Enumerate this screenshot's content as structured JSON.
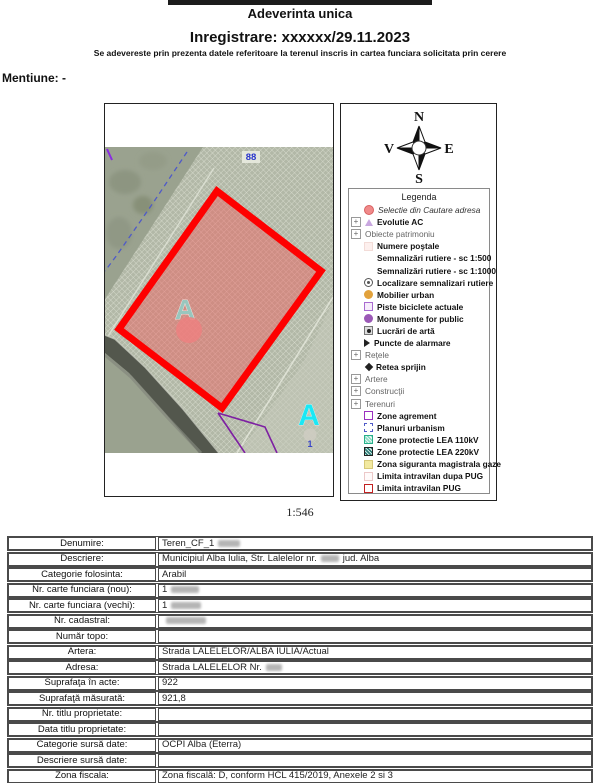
{
  "header": {
    "title": "Adeverinta unica",
    "registration": "Inregistrare: xxxxxx/29.11.2023",
    "subtitle": "Se adevereste prin prezenta datele referitoare la terenul inscris in cartea funciara solicitata prin cerere",
    "mention": "Mentiune: -"
  },
  "map": {
    "scale": "1:546",
    "labels": {
      "parcel": "88",
      "zone_letter": "A",
      "zone_letter_right": "A",
      "point": "1"
    },
    "colors": {
      "selection_stroke": "#fe0000",
      "selection_fill": "rgba(240,90,90,0.45)",
      "marker": "#ef8080",
      "letter_teal": "#8fd0c8",
      "letter_cyan": "#1ae8f5"
    }
  },
  "compass": {
    "north": "N",
    "south": "S",
    "east": "E",
    "west": "V"
  },
  "legend": {
    "title": "Legenda",
    "items": [
      {
        "label": "Selectie din Cautare adresa",
        "icon": "red-circle",
        "italic": true
      },
      {
        "label": "Evolutie AC",
        "icon": "purple-triangle",
        "expand": true,
        "bold": true
      },
      {
        "label": "Obiecte patrimoniu",
        "expand": true,
        "group": true
      },
      {
        "label": "Numere poştale",
        "icon": "pink-square",
        "bold": true
      },
      {
        "label": "Semnalizări rutiere - sc 1:500",
        "bold": true
      },
      {
        "label": "Semnalizări rutiere - sc 1:1000",
        "bold": true
      },
      {
        "label": "Localizare semnalizari rutiere",
        "icon": "circle-dot",
        "bold": true
      },
      {
        "label": "Mobilier urban",
        "icon": "orange-dot",
        "bold": true
      },
      {
        "label": "Piste biciclete actuale",
        "icon": "purple-border-square",
        "bold": true
      },
      {
        "label": "Monumente for public",
        "icon": "purple-dot",
        "bold": true
      },
      {
        "label": "Lucrări de artă",
        "icon": "art-icon",
        "bold": true
      },
      {
        "label": "Puncte de alarmare",
        "icon": "black-triangle-right",
        "bold": true
      },
      {
        "label": "Reţele",
        "expand": true,
        "group": true
      },
      {
        "label": "Retea sprijin",
        "icon": "black-diamond",
        "bold": true
      },
      {
        "label": "Artere",
        "expand": true,
        "group": true
      },
      {
        "label": "Construcţii",
        "expand": true,
        "group": true
      },
      {
        "label": "Terenuri",
        "expand": true,
        "group": true
      },
      {
        "label": "Zone agrement",
        "icon": "purple-square",
        "bold": true
      },
      {
        "label": "Planuri urbanism",
        "icon": "dashed-blue-square",
        "bold": true
      },
      {
        "label": "Zone protectie LEA 110kV",
        "icon": "teal-hatch",
        "bold": true
      },
      {
        "label": "Zone protectie LEA 220kV",
        "icon": "dark-hatch",
        "bold": true
      },
      {
        "label": "Zona siguranta magistrala gaze",
        "icon": "yellow-square",
        "bold": true
      },
      {
        "label": "Limita intravilan dupa PUG",
        "icon": "pink-border-square",
        "bold": true
      },
      {
        "label": "Limita intravilan PUG",
        "icon": "red-border-square",
        "bold": true
      }
    ]
  },
  "table": {
    "rows": [
      {
        "label": "Denumire:",
        "value": "Teren_CF_1",
        "redact": 22
      },
      {
        "label": "Descriere:",
        "value": "Municipiul Alba Iulia, Str. Lalelelor nr.",
        "redact": 18,
        "value2": "jud. Alba"
      },
      {
        "label": "Categorie folosinta:",
        "value": "Arabil"
      },
      {
        "label": "Nr. carte funciara (nou):",
        "value": "1",
        "redact": 28
      },
      {
        "label": "Nr. carte funciara (vechi):",
        "value": "1",
        "redact": 30
      },
      {
        "label": "Nr. cadastral:",
        "value": "",
        "redact": 40
      },
      {
        "label": "Număr topo:",
        "value": ""
      },
      {
        "label": "Artera:",
        "value": "Strada LALELELOR/ALBA IULIA/Actual"
      },
      {
        "label": "Adresa:",
        "value": "Strada LALELELOR Nr.",
        "redact": 16
      },
      {
        "label": "Suprafaţa în acte:",
        "value": "922"
      },
      {
        "label": "Suprafaţă măsurată:",
        "value": "921,8"
      },
      {
        "label": "Nr. titlu proprietate:",
        "value": ""
      },
      {
        "label": "Data titlu proprietate:",
        "value": ""
      },
      {
        "label": "Categorie sursă date:",
        "value": "OCPI Alba (Eterra)"
      },
      {
        "label": "Descriere sursă date:",
        "value": ""
      },
      {
        "label": "Zona fiscala:",
        "value": "Zona fiscală: D, conform HCL 415/2019, Anexele 2 si 3"
      },
      {
        "label": "Intravilan PUG 2014:",
        "value": "INTRAVILAN, conform HCL 158/30.05.2014 de Aprobare P.U.G.2014 ; ACTUAL"
      },
      {
        "label": "Tip proprietate:",
        "value": "Proprietate privata PF"
      }
    ]
  }
}
